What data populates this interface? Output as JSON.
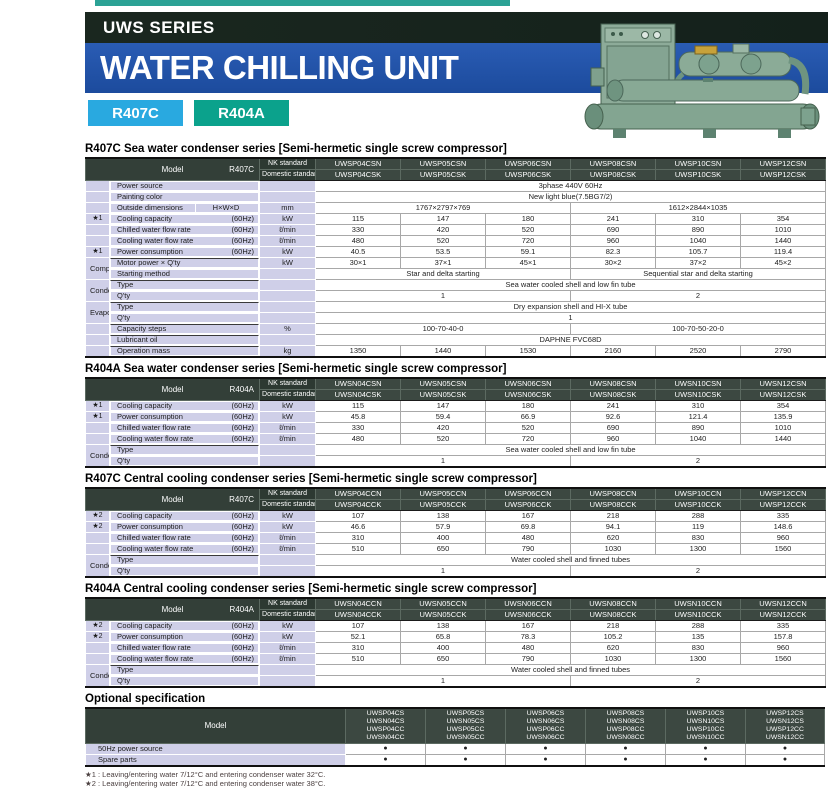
{
  "page": {
    "series_label": "UWS SERIES",
    "title": "WATER CHILLING UNIT",
    "badges": [
      {
        "label": "R407C",
        "color": "#29a9e0"
      },
      {
        "label": "R404A",
        "color": "#0ba28c"
      }
    ]
  },
  "colors": {
    "top_strip": "#2ba295",
    "black_bar": "#14211b",
    "blue_bar": "#1c4b9d",
    "badge_blue": "#29a9e0",
    "badge_teal": "#0ba28c",
    "table_header_dark": "#333f38",
    "label_lavender": "#cfcfe8",
    "machine_green": "#85a792"
  },
  "tables": [
    {
      "title": "R407C Sea water condenser series [Semi-hermetic single screw compressor]",
      "model_label": "Model",
      "refrigerant": "R407C",
      "nk_label": "NK standard",
      "domestic_label": "Domestic standard",
      "nk_models": [
        "UWSP04CSN",
        "UWSP05CSN",
        "UWSP06CSN",
        "UWSP08CSN",
        "UWSP10CSN",
        "UWSP12CSN"
      ],
      "domestic_models": [
        "UWSP04CSK",
        "UWSP05CSK",
        "UWSP06CSK",
        "UWSP08CSK",
        "UWSP10CSK",
        "UWSP12CSK"
      ],
      "rows": [
        {
          "label": "Power source",
          "cells": [
            {
              "t": "3phase 440V  60Hz",
              "s": 6
            }
          ]
        },
        {
          "label": "Painting color",
          "cells": [
            {
              "t": "New light blue(7.5BG7/2)",
              "s": 6
            }
          ]
        },
        {
          "label": "Outside dimensions",
          "sub": "H×W×D",
          "unit": "mm",
          "cells": [
            {
              "t": "1767×2797×769",
              "s": 3
            },
            {
              "t": "1612×2844×1035",
              "s": 3
            }
          ]
        },
        {
          "star": "★1",
          "label": "Cooling capacity",
          "hz": "(60Hz)",
          "unit": "kW",
          "cells": [
            "115",
            "147",
            "180",
            "241",
            "310",
            "354"
          ]
        },
        {
          "label": "Chilled water flow rate",
          "hz": "(60Hz)",
          "unit": "ℓ/min",
          "cells": [
            "330",
            "420",
            "520",
            "690",
            "890",
            "1010"
          ]
        },
        {
          "label": "Cooling water flow rate",
          "hz": "(60Hz)",
          "unit": "ℓ/min",
          "cells": [
            "480",
            "520",
            "720",
            "960",
            "1040",
            "1440"
          ]
        },
        {
          "star": "★1",
          "label": "Power consumption",
          "hz": "(60Hz)",
          "unit": "kW",
          "cells": [
            "40.5",
            "53.5",
            "59.1",
            "82.3",
            "105.7",
            "119.4"
          ]
        },
        {
          "group": "Compressor",
          "gspan": 2,
          "sep": true,
          "label": "Motor power × Q'ty",
          "unit": "kW",
          "cells": [
            "30×1",
            "37×1",
            "45×1",
            "30×2",
            "37×2",
            "45×2"
          ]
        },
        {
          "label": "Starting method",
          "cells": [
            {
              "t": "Star and delta starting",
              "s": 3
            },
            {
              "t": "Sequential star and delta starting",
              "s": 3
            }
          ]
        },
        {
          "group": "Condenser",
          "gspan": 2,
          "sep": true,
          "label": "Type",
          "cells": [
            {
              "t": "Sea water cooled shell and low fin tube",
              "s": 6
            }
          ]
        },
        {
          "label": "Q'ty",
          "cells": [
            {
              "t": "1",
              "s": 3
            },
            {
              "t": "2",
              "s": 3
            }
          ]
        },
        {
          "group": "Evaporator",
          "gspan": 2,
          "sep": true,
          "label": "Type",
          "cells": [
            {
              "t": "Dry expansion shell and HI-X tube",
              "s": 6
            }
          ]
        },
        {
          "label": "Q'ty",
          "cells": [
            {
              "t": "1",
              "s": 6
            }
          ]
        },
        {
          "sep": true,
          "label": "Capacity steps",
          "unit": "%",
          "cells": [
            {
              "t": "100-70-40-0",
              "s": 3
            },
            {
              "t": "100-70-50-20-0",
              "s": 3
            }
          ]
        },
        {
          "sep": true,
          "label": "Lubricant oil",
          "cells": [
            {
              "t": "DAPHNE FVC68D",
              "s": 6
            }
          ]
        },
        {
          "sep": true,
          "label": "Operation mass",
          "unit": "kg",
          "cells": [
            "1350",
            "1440",
            "1530",
            "2160",
            "2520",
            "2790"
          ]
        }
      ]
    },
    {
      "title": "R404A Sea water condenser series [Semi-hermetic single screw compressor]",
      "model_label": "Model",
      "refrigerant": "R404A",
      "nk_label": "NK standard",
      "domestic_label": "Domestic standard",
      "nk_models": [
        "UWSN04CSN",
        "UWSN05CSN",
        "UWSN06CSN",
        "UWSN08CSN",
        "UWSN10CSN",
        "UWSN12CSN"
      ],
      "domestic_models": [
        "UWSN04CSK",
        "UWSN05CSK",
        "UWSN06CSK",
        "UWSN08CSK",
        "UWSN10CSK",
        "UWSN12CSK"
      ],
      "rows": [
        {
          "star": "★1",
          "label": "Cooling capacity",
          "hz": "(60Hz)",
          "unit": "kW",
          "cells": [
            "115",
            "147",
            "180",
            "241",
            "310",
            "354"
          ]
        },
        {
          "star": "★1",
          "label": "Power consumption",
          "hz": "(60Hz)",
          "unit": "kW",
          "cells": [
            "45.8",
            "59.4",
            "66.9",
            "92.6",
            "121.4",
            "135.9"
          ]
        },
        {
          "label": "Chilled water flow rate",
          "hz": "(60Hz)",
          "unit": "ℓ/min",
          "cells": [
            "330",
            "420",
            "520",
            "690",
            "890",
            "1010"
          ]
        },
        {
          "label": "Cooling water flow rate",
          "hz": "(60Hz)",
          "unit": "ℓ/min",
          "cells": [
            "480",
            "520",
            "720",
            "960",
            "1040",
            "1440"
          ]
        },
        {
          "group": "Condenser",
          "gspan": 2,
          "sep": true,
          "label": "Type",
          "cells": [
            {
              "t": "Sea water cooled shell and low fin tube",
              "s": 6
            }
          ]
        },
        {
          "label": "Q'ty",
          "cells": [
            {
              "t": "1",
              "s": 3
            },
            {
              "t": "2",
              "s": 3
            }
          ]
        }
      ]
    },
    {
      "title": "R407C Central cooling condenser series [Semi-hermetic single screw compressor]",
      "model_label": "Model",
      "refrigerant": "R407C",
      "nk_label": "NK standard",
      "domestic_label": "Domestic standard",
      "nk_models": [
        "UWSP04CCN",
        "UWSP05CCN",
        "UWSP06CCN",
        "UWSP08CCN",
        "UWSP10CCN",
        "UWSP12CCN"
      ],
      "domestic_models": [
        "UWSP04CCK",
        "UWSP05CCK",
        "UWSP06CCK",
        "UWSP08CCK",
        "UWSP10CCK",
        "UWSP12CCK"
      ],
      "rows": [
        {
          "star": "★2",
          "label": "Cooling capacity",
          "hz": "(60Hz)",
          "unit": "kW",
          "cells": [
            "107",
            "138",
            "167",
            "218",
            "288",
            "335"
          ]
        },
        {
          "star": "★2",
          "label": "Power consumption",
          "hz": "(60Hz)",
          "unit": "kW",
          "cells": [
            "46.6",
            "57.9",
            "69.8",
            "94.1",
            "119",
            "148.6"
          ]
        },
        {
          "label": "Chilled water flow rate",
          "hz": "(60Hz)",
          "unit": "ℓ/min",
          "cells": [
            "310",
            "400",
            "480",
            "620",
            "830",
            "960"
          ]
        },
        {
          "label": "Cooling water flow rate",
          "hz": "(60Hz)",
          "unit": "ℓ/min",
          "cells": [
            "510",
            "650",
            "790",
            "1030",
            "1300",
            "1560"
          ]
        },
        {
          "group": "Condenser",
          "gspan": 2,
          "sep": true,
          "label": "Type",
          "cells": [
            {
              "t": "Water cooled shell and finned tubes",
              "s": 6
            }
          ]
        },
        {
          "label": "Q'ty",
          "cells": [
            {
              "t": "1",
              "s": 3
            },
            {
              "t": "2",
              "s": 3
            }
          ]
        }
      ]
    },
    {
      "title": "R404A Central cooling condenser series [Semi-hermetic single screw compressor]",
      "model_label": "Model",
      "refrigerant": "R404A",
      "nk_label": "NK standard",
      "domestic_label": "Domestic standard",
      "nk_models": [
        "UWSN04CCN",
        "UWSN05CCN",
        "UWSN06CCN",
        "UWSN08CCN",
        "UWSN10CCN",
        "UWSN12CCN"
      ],
      "domestic_models": [
        "UWSN04CCK",
        "UWSN05CCK",
        "UWSN06CCK",
        "UWSN08CCK",
        "UWSN10CCK",
        "UWSN12CCK"
      ],
      "rows": [
        {
          "star": "★2",
          "label": "Cooling capacity",
          "hz": "(60Hz)",
          "unit": "kW",
          "cells": [
            "107",
            "138",
            "167",
            "218",
            "288",
            "335"
          ]
        },
        {
          "star": "★2",
          "label": "Power consumption",
          "hz": "(60Hz)",
          "unit": "kW",
          "cells": [
            "52.1",
            "65.8",
            "78.3",
            "105.2",
            "135",
            "157.8"
          ]
        },
        {
          "label": "Chilled water flow rate",
          "hz": "(60Hz)",
          "unit": "ℓ/min",
          "cells": [
            "310",
            "400",
            "480",
            "620",
            "830",
            "960"
          ]
        },
        {
          "label": "Cooling water flow rate",
          "hz": "(60Hz)",
          "unit": "ℓ/min",
          "cells": [
            "510",
            "650",
            "790",
            "1030",
            "1300",
            "1560"
          ]
        },
        {
          "group": "Condenser",
          "gspan": 2,
          "sep": true,
          "label": "Type",
          "cells": [
            {
              "t": "Water cooled shell and finned tubes",
              "s": 6
            }
          ]
        },
        {
          "label": "Q'ty",
          "cells": [
            {
              "t": "1",
              "s": 3
            },
            {
              "t": "2",
              "s": 3
            }
          ]
        }
      ]
    }
  ],
  "optional": {
    "title": "Optional specification",
    "model_label": "Model",
    "dot_char": "●",
    "columns": [
      [
        "UWSP04CS",
        "UWSN04CS",
        "UWSP04CC",
        "UWSN04CC"
      ],
      [
        "UWSP05CS",
        "UWSN05CS",
        "UWSP05CC",
        "UWSN05CC"
      ],
      [
        "UWSP06CS",
        "UWSN06CS",
        "UWSP06CC",
        "UWSN06CC"
      ],
      [
        "UWSP08CS",
        "UWSN08CS",
        "UWSP08CC",
        "UWSN08CC"
      ],
      [
        "UWSP10CS",
        "UWSN10CS",
        "UWSP10CC",
        "UWSN10CC"
      ],
      [
        "UWSP12CS",
        "UWSN12CS",
        "UWSP12CC",
        "UWSN12CC"
      ]
    ],
    "rows": [
      {
        "label": "50Hz power source",
        "dots": [
          true,
          true,
          true,
          true,
          true,
          true
        ]
      },
      {
        "label": "Spare parts",
        "dots": [
          true,
          true,
          true,
          true,
          true,
          true
        ]
      }
    ]
  },
  "footnotes": [
    "★1 : Leaving/entering water 7/12°C and entering condenser water 32°C.",
    "★2 : Leaving/entering water 7/12°C and entering condenser water 38°C."
  ]
}
